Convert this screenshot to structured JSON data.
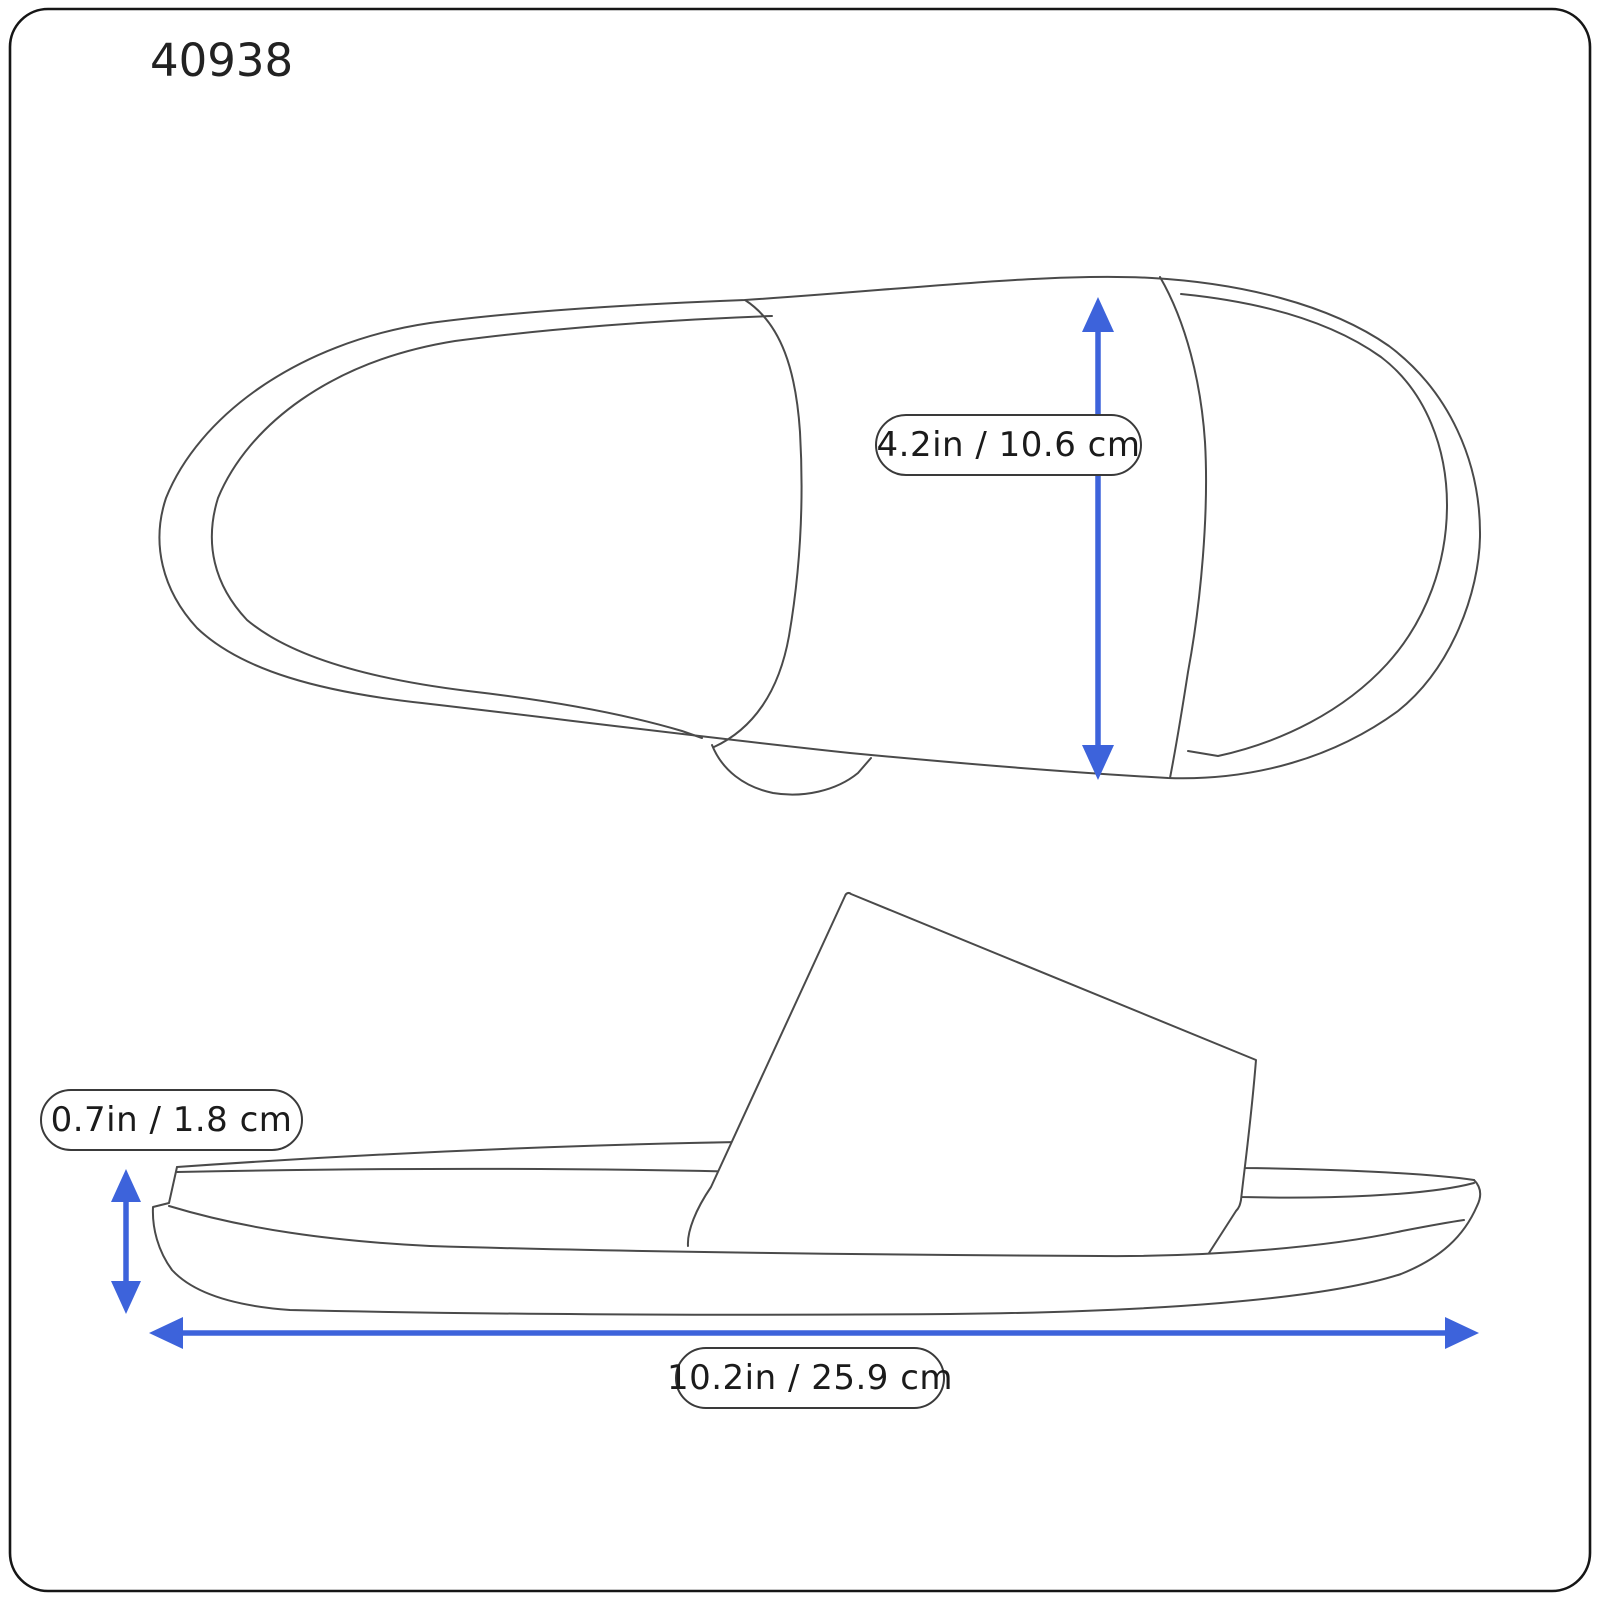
{
  "product_code": "40938",
  "colors": {
    "arrow": "#3D63DB",
    "outline": "#4a4a4a",
    "text": "#222222",
    "background": "#ffffff",
    "pill_border": "#3a3a3a"
  },
  "measurements": {
    "strap_width": "4.2in / 10.6 cm",
    "height": "0.7in / 1.8 cm",
    "length": "10.2in / 25.9 cm"
  }
}
